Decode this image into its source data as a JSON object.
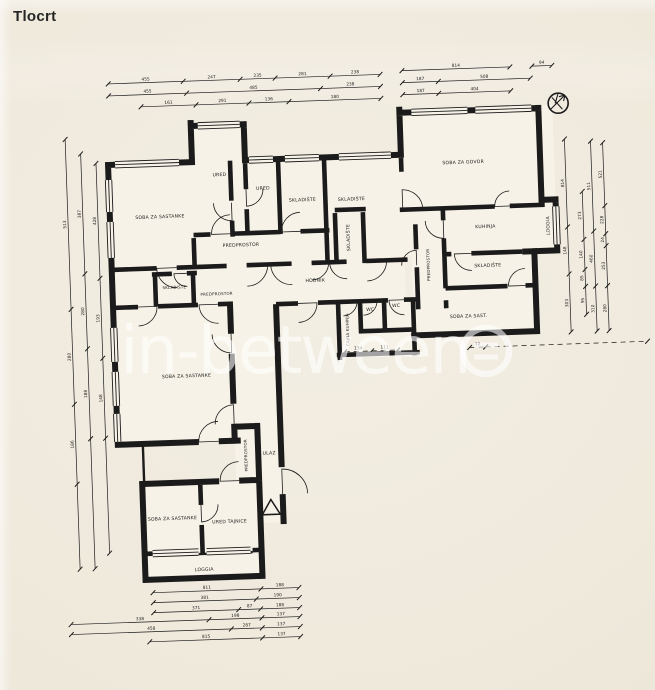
{
  "page": {
    "title": "Tlocrt"
  },
  "watermark": {
    "text": "in-between",
    "logo": "circle-with-lines"
  },
  "colors": {
    "ink": "#1b1b1b",
    "paper": "#efe9dc",
    "room_fill": "#f7f2e7",
    "watermark": "#ffffff"
  },
  "plan": {
    "rooms": [
      {
        "id": "soba-sastanci-1",
        "label": "SOBA ZA SASTANKE",
        "x": 165,
        "y": 212
      },
      {
        "id": "ured-1",
        "label": "URED",
        "x": 226,
        "y": 172
      },
      {
        "id": "ured-2",
        "label": "URED",
        "x": 269,
        "y": 187
      },
      {
        "id": "skladiste-1",
        "label": "SKLADIŠTE",
        "x": 308,
        "y": 200
      },
      {
        "id": "skladiste-2",
        "label": "SKLADIŠTE",
        "x": 357,
        "y": 201
      },
      {
        "id": "skladiste-3",
        "label": "SKLADIŠTE",
        "x": 354,
        "y": 238,
        "rot": -90
      },
      {
        "id": "predprostor-1",
        "label": "PREDPROSTOR",
        "x": 245,
        "y": 243
      },
      {
        "id": "soba-za-govor",
        "label": "SOBA ZA GOVOR",
        "x": 470,
        "y": 168
      },
      {
        "id": "kuhinja",
        "label": "KUHINJA",
        "x": 490,
        "y": 233
      },
      {
        "id": "loggia-1",
        "label": "LOGGIA",
        "x": 554,
        "y": 233,
        "rot": -90
      },
      {
        "id": "predprostor-2",
        "label": "PREDPROSTOR",
        "x": 433,
        "y": 268,
        "rot": -90,
        "size": 4
      },
      {
        "id": "skladiste-4",
        "label": "SKLADIŠTE",
        "x": 491,
        "y": 272
      },
      {
        "id": "soba-sastanci-desno",
        "label": "SOBA ZA SAST.",
        "x": 470,
        "y": 322
      },
      {
        "id": "skladiste-5",
        "label": "SKLADIŠTE",
        "x": 177,
        "y": 283,
        "size": 4
      },
      {
        "id": "predprostor-3",
        "label": "PREDPROSTOR",
        "x": 219,
        "y": 291,
        "size": 4
      },
      {
        "id": "hodnik",
        "label": "HODNIK",
        "x": 318,
        "y": 281
      },
      {
        "id": "cajna-kuhinja",
        "label": "ČAJNA KUHINJA",
        "x": 350,
        "y": 330,
        "rot": -90,
        "size": 4
      },
      {
        "id": "wc-1",
        "label": "WC",
        "x": 372,
        "y": 312
      },
      {
        "id": "wc-2",
        "label": "WC",
        "x": 398,
        "y": 309
      },
      {
        "id": "soba-sastanci-2",
        "label": "SOBA ZA SASTANKE",
        "x": 186,
        "y": 372
      },
      {
        "id": "predprostor-4",
        "label": "PREDPROSTOR",
        "x": 244,
        "y": 452,
        "rot": -90,
        "size": 4
      },
      {
        "id": "ulaz",
        "label": "ULAZ",
        "x": 266,
        "y": 452
      },
      {
        "id": "soba-sastanci-3",
        "label": "SOBA ZA SASTANKE",
        "x": 167,
        "y": 514
      },
      {
        "id": "ured-tajnice",
        "label": "URED TAJNICE",
        "x": 224,
        "y": 519
      },
      {
        "id": "loggia-2",
        "label": "LOGGIA",
        "x": 197,
        "y": 566
      }
    ],
    "symbols": [
      {
        "id": "compass",
        "name": "north-compass"
      },
      {
        "id": "entrance",
        "name": "entrance-arrow"
      }
    ],
    "dims": {
      "horizontal": [
        {
          "y": 76,
          "ticks": [
            118,
            193,
            250,
            285,
            340,
            390
          ],
          "labels": [
            "455",
            "247",
            "235",
            "281",
            "238"
          ]
        },
        {
          "y": 73,
          "ticks": [
            412,
            520
          ],
          "labels": [
            "814"
          ]
        },
        {
          "y": 73,
          "ticks": [
            542,
            562
          ],
          "labels": [
            "94"
          ]
        },
        {
          "y": 88,
          "ticks": [
            118,
            196,
            330,
            390
          ],
          "labels": [
            "455",
            "485",
            "238"
          ]
        },
        {
          "y": 85,
          "ticks": [
            412,
            448,
            540
          ],
          "labels": [
            "187",
            "508"
          ]
        },
        {
          "y": 100,
          "ticks": [
            150,
            205,
            258,
            298,
            390
          ],
          "labels": [
            "161",
            "291",
            "136",
            "180"
          ]
        },
        {
          "y": 97,
          "ticks": [
            412,
            448,
            520
          ],
          "labels": [
            "187",
            "404"
          ]
        },
        {
          "y": 352,
          "dashed": true,
          "ticks": [
            345,
            372,
            398
          ],
          "labels": [
            "134",
            "111"
          ]
        },
        {
          "y": 352,
          "dashed": true,
          "ticks": [
            470,
            486
          ],
          "labels": [
            "12"
          ]
        },
        {
          "y": 352,
          "dashed": true,
          "ticks": [
            486,
            648
          ],
          "labels": [
            ""
          ]
        },
        {
          "y": 586,
          "ticks": [
            145,
            253,
            291
          ],
          "labels": [
            "811",
            "188"
          ]
        },
        {
          "y": 596,
          "ticks": [
            145,
            248,
            291
          ],
          "labels": [
            "381",
            "190"
          ]
        },
        {
          "y": 606,
          "ticks": [
            145,
            230,
            252,
            291
          ],
          "labels": [
            "371",
            "87",
            "188"
          ]
        },
        {
          "y": 615,
          "ticks": [
            62,
            200,
            253,
            291
          ],
          "labels": [
            "338",
            "198",
            "137"
          ]
        },
        {
          "y": 625,
          "ticks": [
            62,
            222,
            253,
            291
          ],
          "labels": [
            "458",
            "287",
            "137"
          ]
        },
        {
          "y": 635,
          "ticks": [
            140,
            253,
            291
          ],
          "labels": [
            "815",
            "137"
          ]
        }
      ],
      "vertical": [
        {
          "x": 73,
          "ticks": [
            130,
            300,
            395,
            475,
            560
          ],
          "labels": [
            "513",
            "280",
            "186",
            ""
          ]
        },
        {
          "x": 88,
          "ticks": [
            145,
            265,
            340,
            430,
            560
          ],
          "labels": [
            "387",
            "280",
            "188",
            ""
          ]
        },
        {
          "x": 103,
          "ticks": [
            155,
            270,
            350,
            430,
            545
          ],
          "labels": [
            "428",
            "193",
            "148",
            ""
          ]
        },
        {
          "x": 572,
          "ticks": [
            147,
            235,
            282,
            340
          ],
          "labels": [
            "814",
            "148",
            "303"
          ]
        },
        {
          "x": 588,
          "ticks": [
            200,
            248,
            278,
            295,
            323
          ],
          "labels": [
            "273",
            "140",
            "85",
            "95"
          ]
        },
        {
          "x": 598,
          "ticks": [
            150,
            240,
            295,
            340
          ],
          "labels": [
            "511",
            "460",
            "310"
          ]
        },
        {
          "x": 610,
          "ticks": [
            152,
            215,
            243,
            255,
            295,
            340
          ],
          "labels": [
            "521",
            "228",
            "24",
            "253",
            "280"
          ]
        }
      ]
    }
  }
}
